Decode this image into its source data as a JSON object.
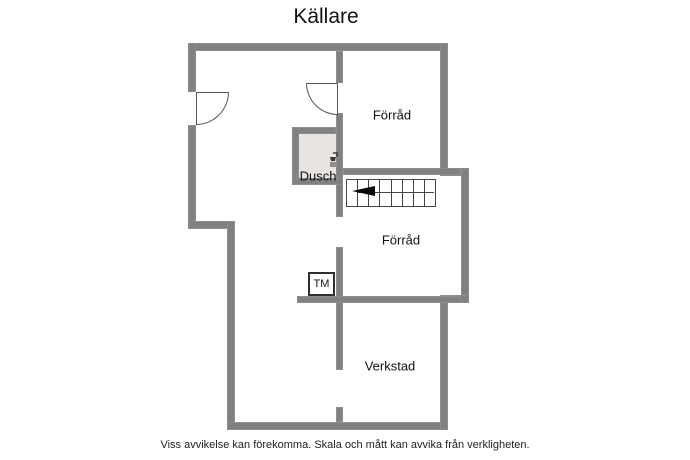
{
  "page": {
    "title": "Källare",
    "disclaimer": "Viss avvikelse kan förekomma. Skala och mått kan avvika från verkligheten."
  },
  "floorplan": {
    "rooms": [
      {
        "name": "forrad-top",
        "label": "Förråd"
      },
      {
        "name": "dusch",
        "label": "Dusch"
      },
      {
        "name": "forrad-middle",
        "label": "Förråd"
      },
      {
        "name": "verkstad",
        "label": "Verkstad"
      }
    ],
    "appliances": [
      {
        "name": "washing-machine",
        "label": "TM"
      }
    ],
    "stairs": {
      "treads": 8,
      "direction_arrow": "left"
    },
    "doors": 2,
    "icons": [
      {
        "name": "shower-icon"
      }
    ],
    "colors": {
      "wall": "#818181",
      "shower_floor": "#e8e4df",
      "thin_outline": "#444444",
      "text": "#111111",
      "background": "#ffffff"
    }
  }
}
